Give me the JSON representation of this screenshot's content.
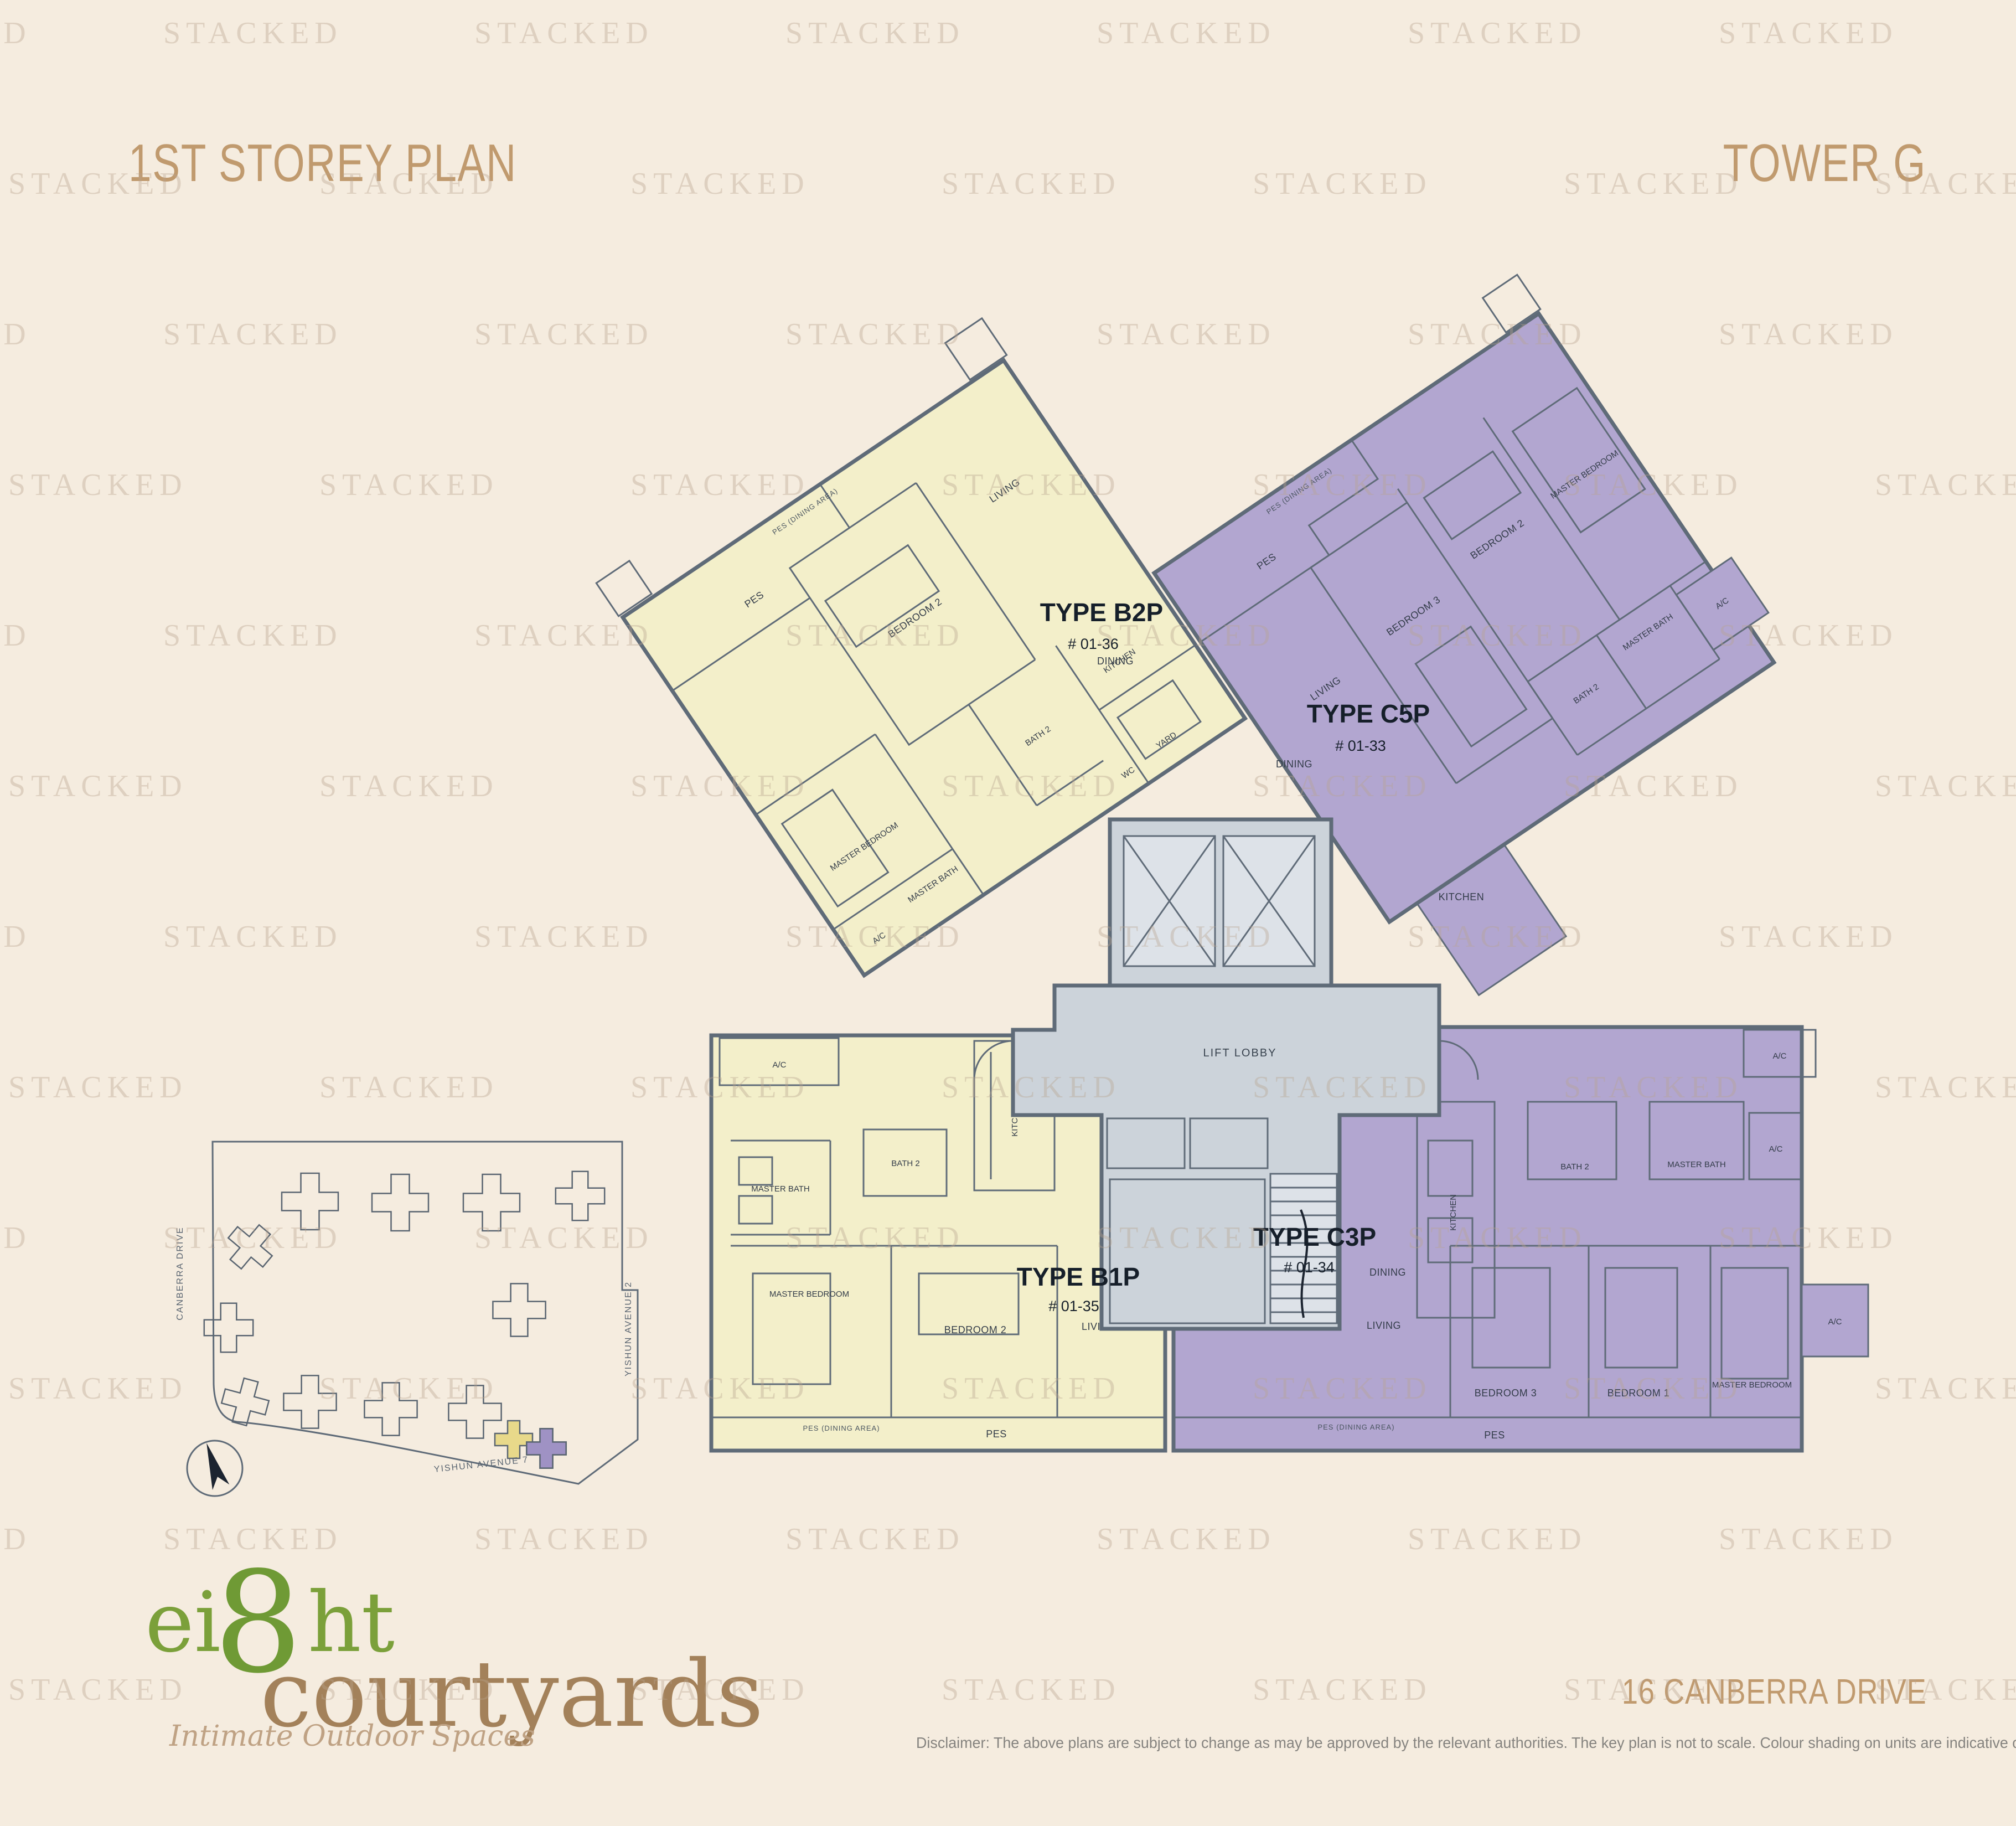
{
  "header": {
    "title": "1ST STOREY PLAN",
    "tower": "TOWER G"
  },
  "watermark": {
    "text": "STACKED"
  },
  "room_labels": {
    "pes": "PES",
    "pes_dining": "PES (DINING AREA)",
    "living": "LIVING",
    "dining": "DINING",
    "kitchen": "KITCHEN",
    "yard": "YARD",
    "wc": "WC",
    "bedroom1": "BEDROOM 1",
    "bedroom2": "BEDROOM 2",
    "bedroom3": "BEDROOM 3",
    "master_bedroom": "MASTER BEDROOM",
    "master_bath": "MASTER BATH",
    "bath2": "BATH 2",
    "ac": "A/C",
    "lift_lobby": "LIFT LOBBY"
  },
  "units": {
    "b2p": {
      "label": "TYPE B2P",
      "unit_no": "# 01-36"
    },
    "c5p": {
      "label": "TYPE C5P",
      "unit_no": "# 01-33"
    },
    "b1p": {
      "label": "TYPE B1P",
      "unit_no": "# 01-35"
    },
    "c3p": {
      "label": "TYPE C3P",
      "unit_no": "# 01-34"
    }
  },
  "key_plan": {
    "road_left": "CANBERRA DRIVE",
    "road_right": "YISHUN AVENUE 2",
    "road_bottom": "YISHUN AVENUE 7"
  },
  "footer": {
    "logo_ei": "ei",
    "logo_8": "8",
    "logo_ht": "ht",
    "logo_courtyards": "courtyards",
    "tagline": "Intimate Outdoor Spaces",
    "address": "16 CANBERRA DRIVE",
    "disclaimer": "Disclaimer: The above plans are subject to change as may be approved by the relevant authorities. The key plan is not to scale. Colour shading on units are indicative only."
  },
  "colors": {
    "accent": "#c09a6e",
    "unit_b_fill": "#f3efca",
    "unit_c_fill": "#b2a6d0",
    "common_fill": "#ccd3da",
    "wall": "#5f6b78"
  }
}
